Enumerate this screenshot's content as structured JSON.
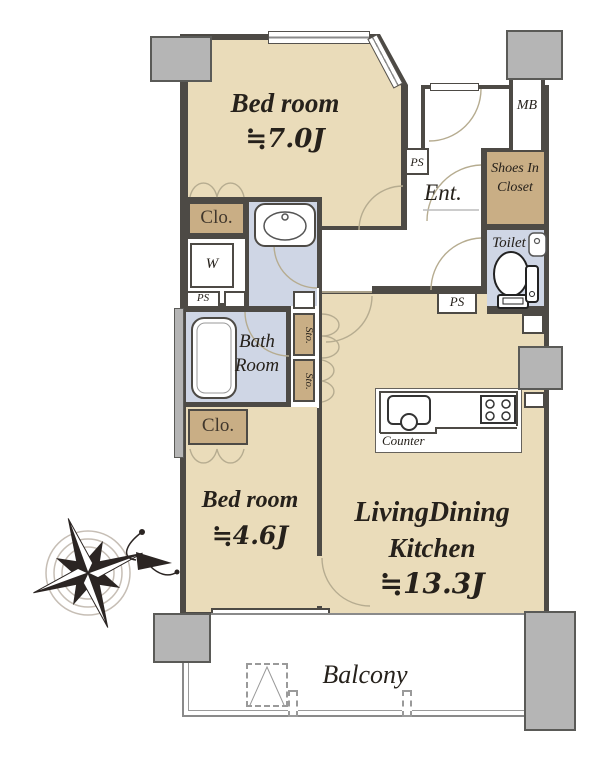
{
  "plan": {
    "rooms": {
      "bedroom1": {
        "name": "Bed room",
        "size": "≒7.0J"
      },
      "bedroom2": {
        "name": "Bed room",
        "size": "≒4.6J"
      },
      "ldk": {
        "name_line1": "LivingDining",
        "name_line2": "Kitchen",
        "size": "≒13.3J"
      },
      "bathroom": {
        "line1": "Bath",
        "line2": "Room"
      },
      "entrance": {
        "label": "Ent."
      },
      "shoes_in_closet": {
        "line1": "Shoes In",
        "line2": "Closet"
      },
      "toilet": {
        "label": "Toilet"
      },
      "balcony": {
        "label": "Balcony"
      },
      "kitchen_counter": {
        "label": "Counter"
      }
    },
    "small_labels": {
      "mb": "MB",
      "ps": "PS",
      "w": "W",
      "clo": "Clo.",
      "sto": "Sto."
    },
    "colors": {
      "room_tan": "#eadcba",
      "closet_tan": "#c9ae85",
      "wet_blue": "#cfd6e5",
      "wall": "#4d4a45",
      "pillar": "#b5b5b5",
      "arc": "#b6ac90"
    }
  }
}
